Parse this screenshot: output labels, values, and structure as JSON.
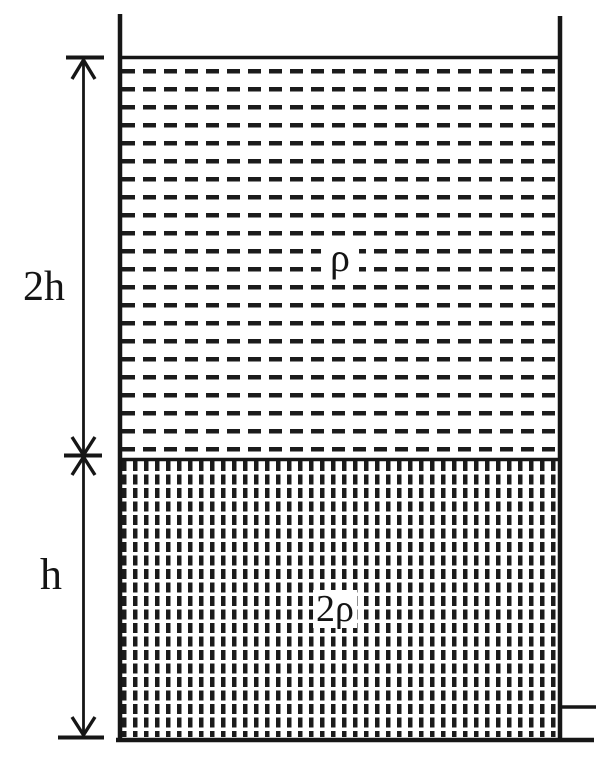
{
  "diagram": {
    "description": "Container holding two stacked liquid layers",
    "dimension_labels": {
      "top_layer_height": "2h",
      "bottom_layer_height": "h"
    },
    "density_labels": {
      "top_layer": "ρ",
      "bottom_layer": "2ρ"
    },
    "colors": {
      "ink": "#161616",
      "background": "#ffffff"
    }
  }
}
